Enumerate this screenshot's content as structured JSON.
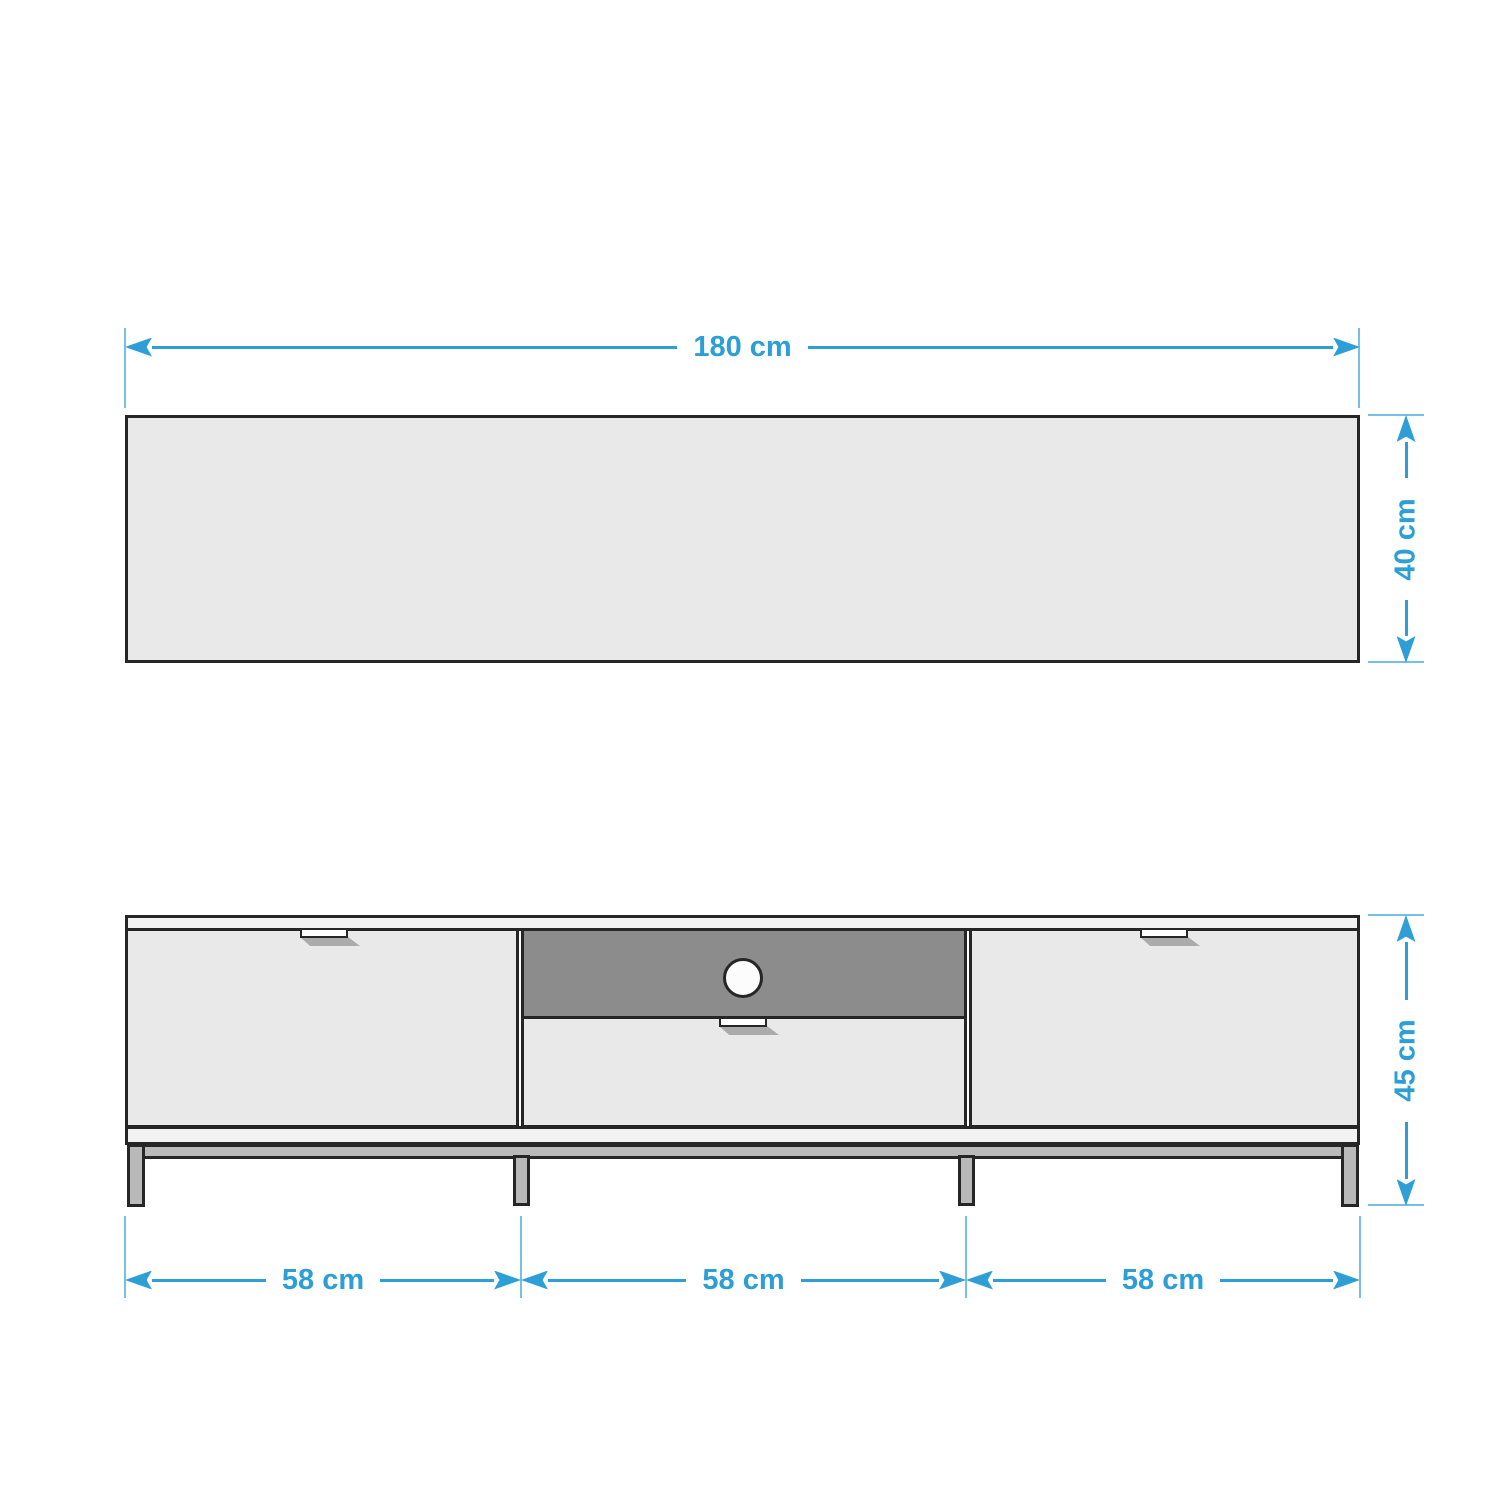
{
  "diagram": {
    "description": "TV lowboard dimension drawing, top view and front view",
    "colors": {
      "dimension_blue": "#2D9FD6",
      "extension_blue": "#74C0E6",
      "outline_dark": "#262626",
      "panel_light": "#E9E9E9",
      "panel_lighter": "#F2F2F2",
      "compartment_dark": "#8C8C8C",
      "metal_gray": "#B9B9B9",
      "shadow_gray": "#ABABAB"
    },
    "top_view": {
      "width_label": "180 cm",
      "depth_label": "40 cm"
    },
    "front_view": {
      "height_label": "45 cm",
      "section_labels": [
        "58 cm",
        "58 cm",
        "58 cm"
      ]
    }
  }
}
